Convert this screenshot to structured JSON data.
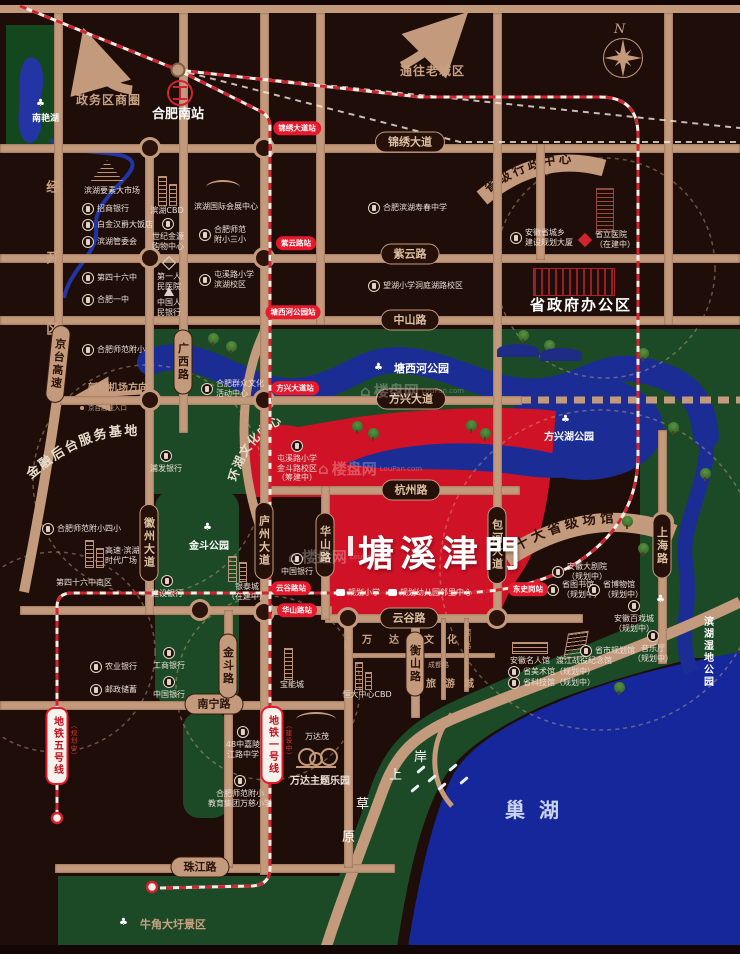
{
  "compass": "N",
  "zone": "经开区",
  "hub": "合肥南站",
  "lake": "巢湖",
  "arrows": {
    "business": "政务区商圈",
    "old_town": "通往老城区",
    "airport": "新桥机场方向",
    "hw_entry": "京台高速入口"
  },
  "curved": {
    "admin": "省级行政中心",
    "venues": "十大省级场馆",
    "finance": "金融后台服务基地",
    "culture": "环湖文化中心"
  },
  "gov": "省政府办公区",
  "property": {
    "name": "塘溪津門"
  },
  "watermark": {
    "brand": "楼盘网",
    "domain": "LouPan.com"
  },
  "coast_chars": [
    "岸",
    "上",
    "草",
    "原"
  ],
  "roads_h": [
    "锦绣大道",
    "紫云路",
    "中山路",
    "方兴大道",
    "杭州路",
    "云谷路",
    "南宁路",
    "珠江路"
  ],
  "roads_v": [
    "京台高速",
    "广西路",
    "徽州大道",
    "庐州大道",
    "华山路",
    "包河大道",
    "上海路",
    "金斗路",
    "衡山路"
  ],
  "roads_small": [
    "珠海路",
    "澳门路",
    "成都路"
  ],
  "wanda": [
    "万达",
    "文化",
    "旅游城"
  ],
  "stations": [
    "锦绣大道站",
    "紫云路站",
    "塘西河公园站",
    "方兴大道站",
    "云谷路站",
    "华山路站",
    "东史岗站"
  ],
  "metro": [
    {
      "name": "地铁一号线",
      "status": "（建设中）"
    },
    {
      "name": "地铁五号线",
      "status": "（规划中）"
    }
  ],
  "parks": [
    "南艳湖",
    "塘西河公园",
    "方兴湖公园",
    "金斗公园",
    "滨湖湿地公园",
    "牛角大圩景区"
  ],
  "pois": [
    "招商银行",
    "白金汉爵大饭店",
    "滨湖管委会",
    "滨湖要素大市场",
    "滨湖CBD",
    "世纪金源\n购物中心",
    "滨湖国际会展中心",
    "合肥师范\n附小三小",
    "第四十六中",
    "合肥一中",
    "第一人\n民医院",
    "中国人\n民银行",
    "屯溪路小学\n滨湖校区",
    "合肥滨湖寿春中学",
    "望湖小学洞庭湖路校区",
    "合肥师范附小",
    "合肥群众文化\n活动中心",
    "浦发银行",
    "合肥师范附小四小",
    "高速·滨湖\n时代广场",
    "第四十六中南区",
    "建设银行",
    "银泰城\n（在建中）",
    "中国银行",
    "屯溪路小学\n金斗路校区\n（筹建中）",
    "工商银行",
    "中国银行",
    "农业银行",
    "邮政储蓄",
    "宝能城",
    "恒大中心CBD",
    "万达茂",
    "万达主题乐园",
    "48中嘉陵\n江路中学",
    "合肥师范附小\n教育集团万慈小学",
    "安徽省城乡\n建设规划大厦",
    "省立医院\n（在建中）",
    "安徽大剧院\n（规划中）",
    "省图书馆\n（规划中）",
    "省博物馆\n（规划中）",
    "安徽百戏城\n（规划中）",
    "音乐厅\n（规划中）",
    "省市规划馆",
    "安徽名人馆",
    "渡江战役纪念馆",
    "省美术馆（规划中）",
    "省科技馆（规划中）",
    "规划小学",
    "规划幼儿园",
    "邻里中心"
  ]
}
